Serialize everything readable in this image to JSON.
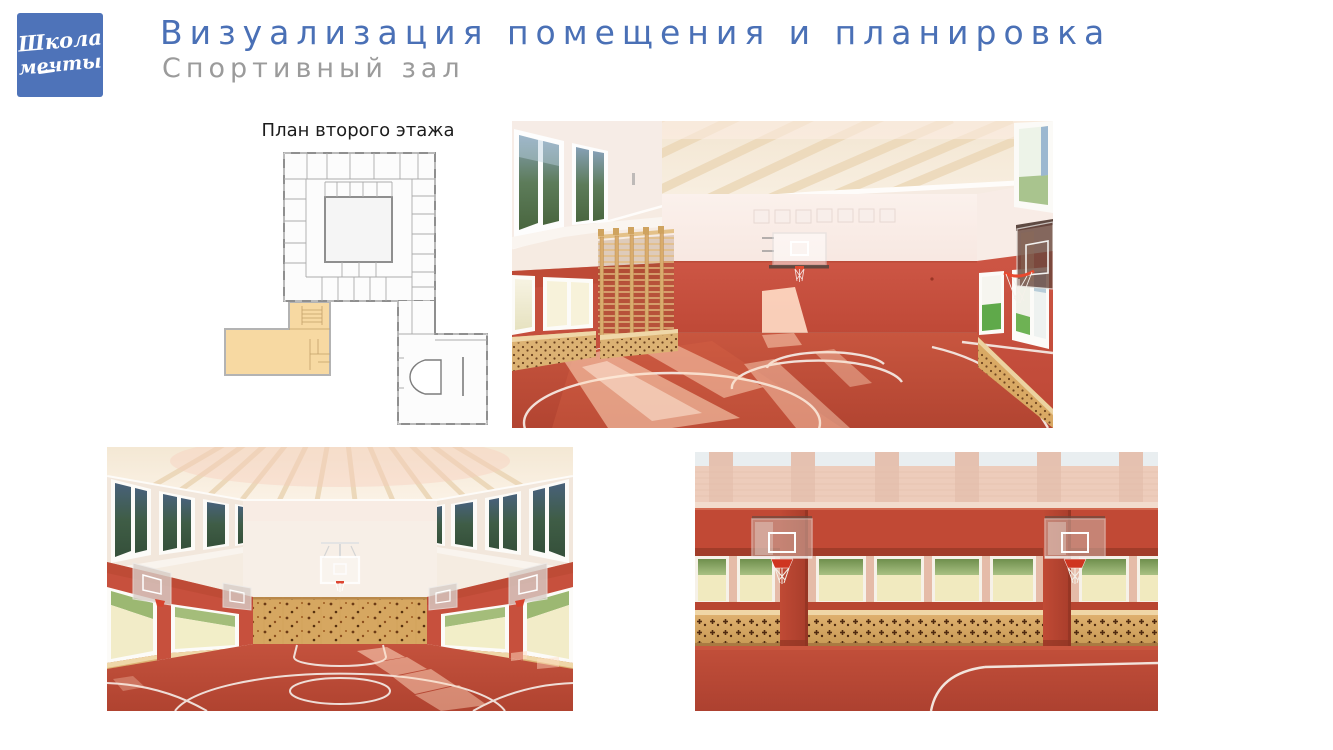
{
  "logo": {
    "line1": "Школа",
    "line2": "мечты",
    "bg_color": "#4e73b9",
    "text_color": "#ffffff"
  },
  "header": {
    "title": "Визуализация помещения и планировка",
    "subtitle": "Спортивный зал",
    "title_color": "#4a70b6",
    "subtitle_color": "#9b9b9b"
  },
  "floor_plan": {
    "label": "План второго этажа",
    "highlight_color": "#f7d9a2",
    "wall_color": "#8f8f8f"
  },
  "renders": {
    "main_view": "gym-interior-perspective",
    "end_view": "gym-end-wall-with-climbing-wall",
    "closeup_view": "gym-side-wall-closeup"
  },
  "palette": {
    "floor_red": "#bf4d3b",
    "wall_red": "#c9503e",
    "ceiling_cream": "#f6ebd9",
    "upper_wall_pink": "#f9eee9",
    "wood_tan": "#d9ab68",
    "court_line": "#f3e6e0",
    "window_green": "#9cb872"
  }
}
